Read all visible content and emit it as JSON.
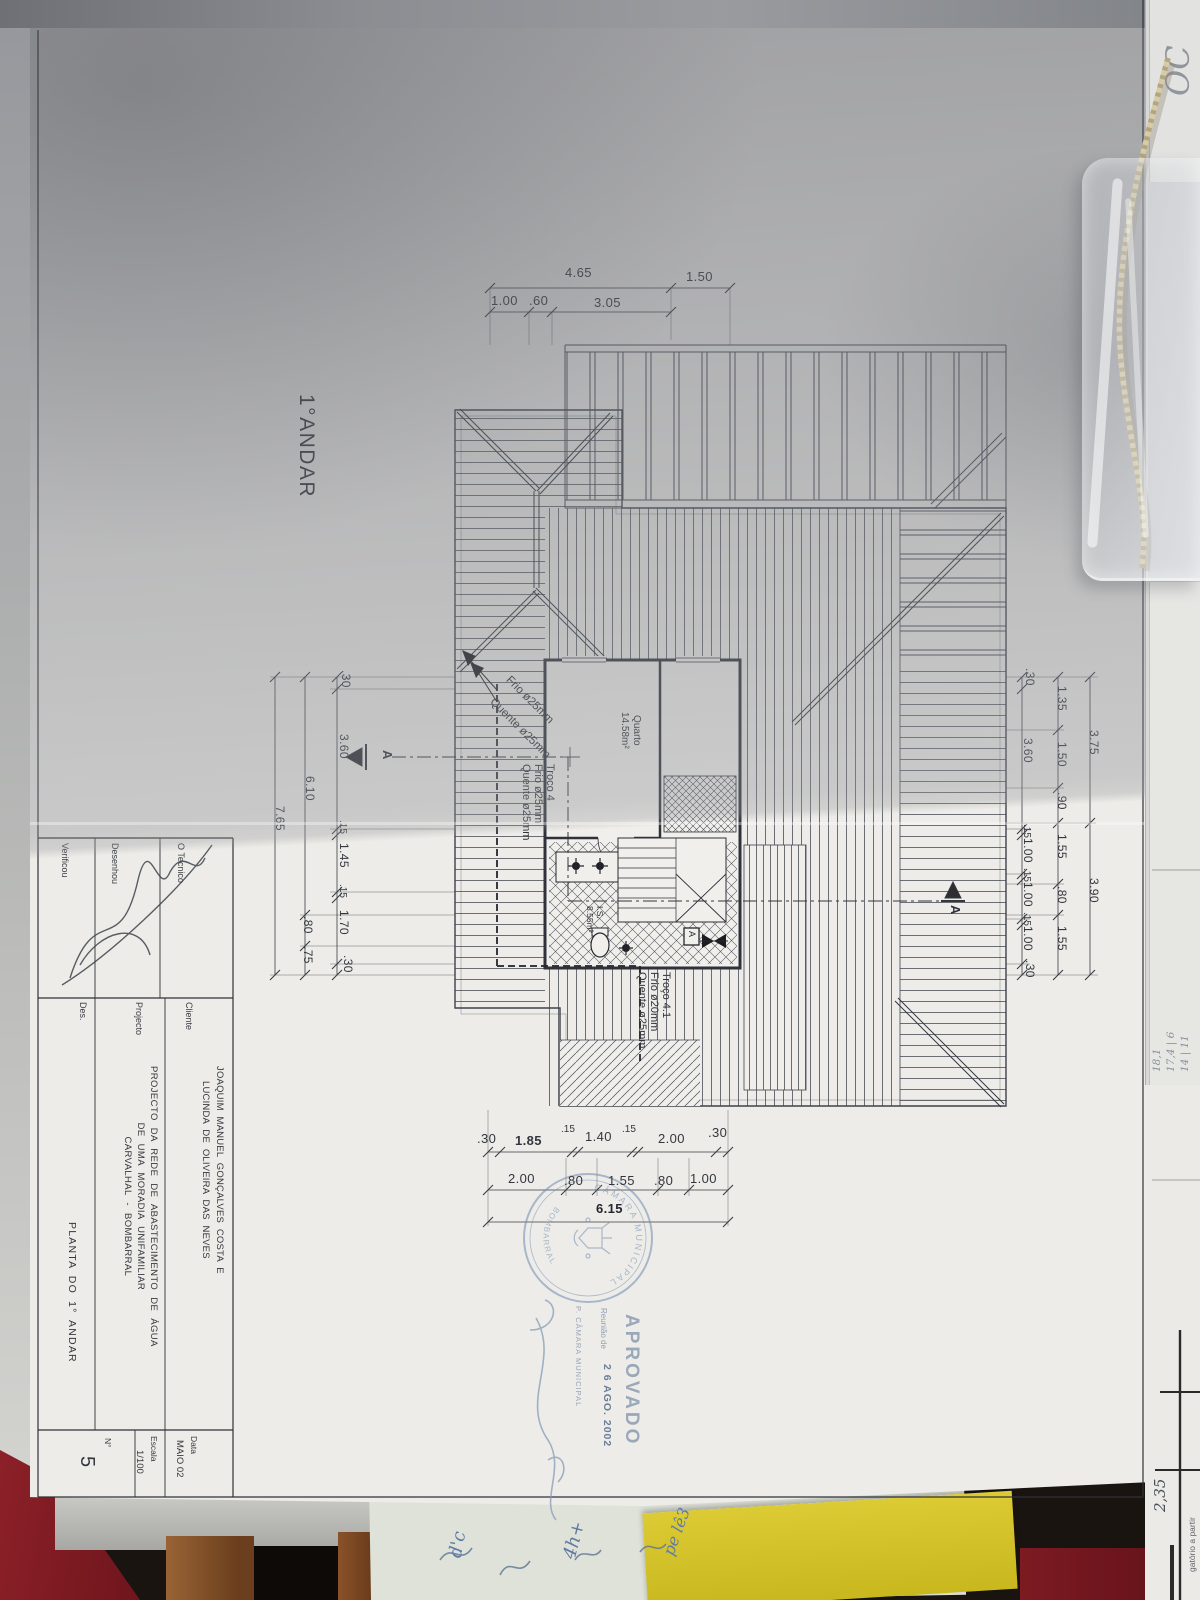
{
  "colors": {
    "stamp_blue": "#6f8cb0",
    "cloth_red": "#7d1a22",
    "note_yellow": "#d7c42e",
    "wood_brown": "#8f5d35",
    "paper_bright": "#edece8",
    "paper_shadow": "#a2a4a9"
  },
  "drawing": {
    "floor_label": "1°ANDAR",
    "dims": {
      "top1": [
        "4.65",
        "1.50"
      ],
      "top2": [
        "1.00",
        ".60",
        "3.05"
      ],
      "left_inner": [
        ".30",
        "3.60",
        ".15",
        "1.45",
        ".15",
        "1.70",
        ".30"
      ],
      "left_mid": [
        "6.10",
        ".80",
        ".75"
      ],
      "left_outer": [
        "7.65"
      ],
      "right_inner": [
        ".30",
        "3.60",
        ".15",
        "1.00",
        ".15",
        "1.00",
        ".15",
        "1.00",
        ".30"
      ],
      "right_mid": [
        "1.35",
        "1.50",
        ".90",
        "1.55",
        ".80",
        "1.55"
      ],
      "right_outer": [
        "3.75",
        "3.90"
      ],
      "bottom1": [
        ".30",
        "1.85",
        ".15",
        "1.40",
        ".15",
        "2.00",
        ".30"
      ],
      "bottom2": [
        "2.00",
        ".80",
        "1.55",
        ".80",
        "1.00"
      ],
      "bottom3": "6.15"
    },
    "annotations": {
      "frio_leader": "Frio ø25mm",
      "quente_leader": "Quente ø25mm",
      "troco4": "Troço 4\nFrio ø25mm\nQuente ø25mm",
      "troco41": "Troço 4.1\nFrio ø20mm\nQuente ø25mm",
      "quarto": "Quarto\n14.58m²",
      "is_room": "I.S.\n8.55m²",
      "section_label": "A",
      "valve_label": "A"
    },
    "title_block": {
      "tecnico_label": "O Tecnico",
      "desenhou_label": "Desenhou",
      "verificou_label": "Verificou",
      "cliente_label": "Cliente",
      "cliente_name": "JOAQUIM MANUEL GONÇALVES COSTA E\nLUCINDA DE OLIVEIRA DAS NEVES",
      "projecto_label": "Projecto",
      "projecto_text": "PROJECTO DA REDE DE ABASTECIMENTO DE ÁGUA\nDE UMA MORADIA UNIFAMILIAR\nCARVALHAL - BOMBARRAL",
      "des_label": "Des.",
      "des_value": "PLANTA DO 1° ANDAR",
      "data_label": "Data",
      "data_value": "MAIO 02",
      "escala_label": "Escala",
      "escala_value": "1/100",
      "numero_label": "N°",
      "numero_value": "5"
    },
    "stamp": {
      "approved": "APROVADO",
      "meeting_line": "Reunião de",
      "date": "2 6 AGO. 2002",
      "issuer_line": "P. CÂMARA MUNICIPAL",
      "seal_top": "CÂMARA MUNICIPAL",
      "seal_bottom": "BOMBARRAL"
    }
  },
  "surroundings": {
    "corner_scribble": "OC",
    "note_numbers": "18,1\n17,4 | 6\n14 | 11",
    "grid_number": "2,35",
    "edge_print": "gatório a partir",
    "scrap_note_1": "d'c",
    "scrap_note_2": "4h+",
    "scrap_note_3": "pe lê3"
  }
}
